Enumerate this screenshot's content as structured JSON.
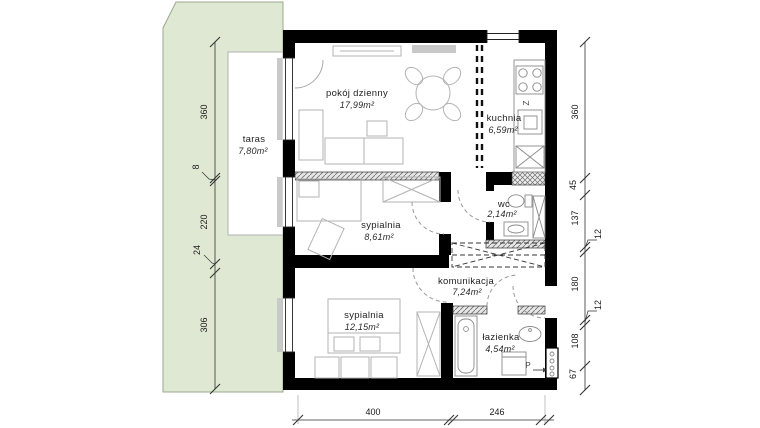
{
  "rooms": {
    "living": {
      "name": "pokój dzienny",
      "area": "17,99m²"
    },
    "kitchen": {
      "name": "kuchnia",
      "area": "6,59m²"
    },
    "bedroom1": {
      "name": "sypialnia",
      "area": "8,61m²"
    },
    "wc": {
      "name": "wc",
      "area": "2,14m²"
    },
    "hall": {
      "name": "komunikacja",
      "area": "7,24m²"
    },
    "bedroom2": {
      "name": "sypialnia",
      "area": "12,15m²"
    },
    "bath": {
      "name": "łazienka",
      "area": "4,54m²"
    },
    "terrace": {
      "name": "taras",
      "area": "7,80m²"
    }
  },
  "dimensions": {
    "left": [
      "360",
      "8",
      "220",
      "24",
      "306"
    ],
    "right": [
      "360",
      "45",
      "137",
      "12",
      "180",
      "12",
      "108",
      "67"
    ],
    "bottom": [
      "400",
      "246"
    ]
  },
  "symbols": {
    "sink": "Z",
    "washer": "P"
  },
  "colors": {
    "terrace_fill": "#dfe8d2",
    "wall": "#000000",
    "furniture": "#b3b3b3"
  }
}
